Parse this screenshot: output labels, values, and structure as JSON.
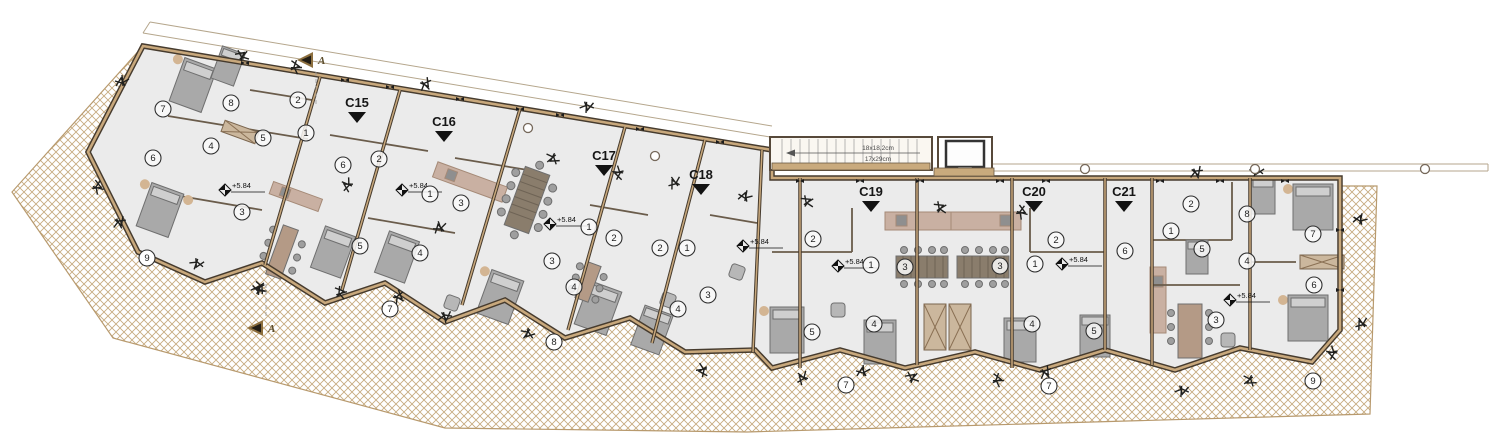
{
  "plan": {
    "drawing_type": "apartment-building-floor-plan",
    "unit_labels": [
      {
        "label": "C15",
        "x": 357,
        "y": 107
      },
      {
        "label": "C16",
        "x": 444,
        "y": 126
      },
      {
        "label": "C17",
        "x": 604,
        "y": 160
      },
      {
        "label": "C18",
        "x": 701,
        "y": 179
      },
      {
        "label": "C19",
        "x": 871,
        "y": 196
      },
      {
        "label": "C20",
        "x": 1034,
        "y": 196
      },
      {
        "label": "C21",
        "x": 1124,
        "y": 196
      }
    ],
    "section_markers": [
      {
        "label": "A",
        "x": 316,
        "y": 60,
        "dir": 1
      },
      {
        "label": "A",
        "x": 266,
        "y": 328,
        "dir": -1
      }
    ],
    "stair": {
      "line1": "18x18,2cm",
      "line2": "17x29cm"
    },
    "elevation_markers": [
      {
        "label": "+5.84",
        "x": 225,
        "y": 190
      },
      {
        "label": "+5.84",
        "x": 402,
        "y": 190
      },
      {
        "label": "+5.84",
        "x": 550,
        "y": 224
      },
      {
        "label": "+5.84",
        "x": 743,
        "y": 246
      },
      {
        "label": "+5.84",
        "x": 838,
        "y": 266
      },
      {
        "label": "+5.84",
        "x": 1062,
        "y": 264
      },
      {
        "label": "+5.84",
        "x": 1230,
        "y": 300
      }
    ],
    "room_numbers": [
      [
        163,
        109,
        "7"
      ],
      [
        231,
        103,
        "8"
      ],
      [
        298,
        100,
        "2"
      ],
      [
        306,
        133,
        "1"
      ],
      [
        263,
        138,
        "5"
      ],
      [
        211,
        146,
        "4"
      ],
      [
        153,
        158,
        "6"
      ],
      [
        242,
        212,
        "3"
      ],
      [
        343,
        165,
        "6"
      ],
      [
        379,
        159,
        "2"
      ],
      [
        430,
        194,
        "1"
      ],
      [
        360,
        246,
        "5"
      ],
      [
        420,
        253,
        "4"
      ],
      [
        461,
        203,
        "3"
      ],
      [
        589,
        227,
        "1"
      ],
      [
        614,
        238,
        "2"
      ],
      [
        552,
        261,
        "3"
      ],
      [
        574,
        287,
        "4"
      ],
      [
        660,
        248,
        "2"
      ],
      [
        687,
        248,
        "1"
      ],
      [
        708,
        295,
        "3"
      ],
      [
        678,
        309,
        "4"
      ],
      [
        813,
        239,
        "2"
      ],
      [
        871,
        265,
        "1"
      ],
      [
        905,
        267,
        "3"
      ],
      [
        812,
        332,
        "5"
      ],
      [
        874,
        324,
        "4"
      ],
      [
        1000,
        266,
        "3"
      ],
      [
        1035,
        264,
        "1"
      ],
      [
        1056,
        240,
        "2"
      ],
      [
        1032,
        324,
        "4"
      ],
      [
        1094,
        331,
        "5"
      ],
      [
        1125,
        251,
        "6"
      ],
      [
        1191,
        204,
        "2"
      ],
      [
        1171,
        231,
        "1"
      ],
      [
        1202,
        249,
        "5"
      ],
      [
        1247,
        214,
        "8"
      ],
      [
        1247,
        261,
        "4"
      ],
      [
        1216,
        320,
        "3"
      ],
      [
        1313,
        234,
        "7"
      ],
      [
        1314,
        285,
        "6"
      ]
    ],
    "terrace_numbers": [
      [
        147,
        258,
        "9"
      ],
      [
        390,
        309,
        "7"
      ],
      [
        554,
        342,
        "8"
      ],
      [
        846,
        385,
        "7"
      ],
      [
        1049,
        386,
        "7"
      ],
      [
        1313,
        381,
        "9"
      ]
    ],
    "wall_ticks": [
      [
        245,
        63
      ],
      [
        345,
        80
      ],
      [
        390,
        87
      ],
      [
        460,
        99
      ],
      [
        520,
        109
      ],
      [
        560,
        115
      ],
      [
        640,
        129
      ],
      [
        720,
        142
      ],
      [
        800,
        181
      ],
      [
        860,
        181
      ],
      [
        920,
        181
      ],
      [
        1000,
        181
      ],
      [
        1046,
        181
      ],
      [
        1160,
        181
      ],
      [
        1220,
        181
      ],
      [
        1285,
        181
      ],
      [
        1340,
        230
      ],
      [
        1340,
        290
      ]
    ],
    "plants": [
      [
        122,
        82
      ],
      [
        242,
        56
      ],
      [
        295,
        67
      ],
      [
        425,
        84
      ],
      [
        587,
        106
      ],
      [
        553,
        158
      ],
      [
        619,
        173
      ],
      [
        675,
        183
      ],
      [
        745,
        197
      ],
      [
        807,
        202
      ],
      [
        97,
        187
      ],
      [
        119,
        222
      ],
      [
        197,
        263
      ],
      [
        261,
        287
      ],
      [
        348,
        185
      ],
      [
        440,
        228
      ],
      [
        258,
        290
      ],
      [
        340,
        293
      ],
      [
        398,
        297
      ],
      [
        445,
        316
      ],
      [
        528,
        333
      ],
      [
        703,
        370
      ],
      [
        803,
        378
      ],
      [
        863,
        372
      ],
      [
        912,
        378
      ],
      [
        997,
        380
      ],
      [
        1045,
        372
      ],
      [
        1182,
        390
      ],
      [
        1250,
        380
      ],
      [
        1333,
        353
      ],
      [
        1362,
        324
      ],
      [
        1360,
        220
      ],
      [
        940,
        208
      ],
      [
        1021,
        212
      ],
      [
        1196,
        172
      ],
      [
        1257,
        170
      ]
    ],
    "columns": [
      [
        528,
        128
      ],
      [
        655,
        156
      ],
      [
        1085,
        169
      ],
      [
        1255,
        169
      ],
      [
        1425,
        169
      ]
    ],
    "colors": {
      "wall_dark": "#463b2e",
      "wall_tan": "#c8a87c",
      "floor": "#ebebeb",
      "hatch_line": "#c6ab80",
      "kitchen": "#c9b0a2",
      "furniture_gray": "#a9a9a9",
      "text_black": "#161616",
      "section_gold": "#8c6f3f"
    }
  }
}
